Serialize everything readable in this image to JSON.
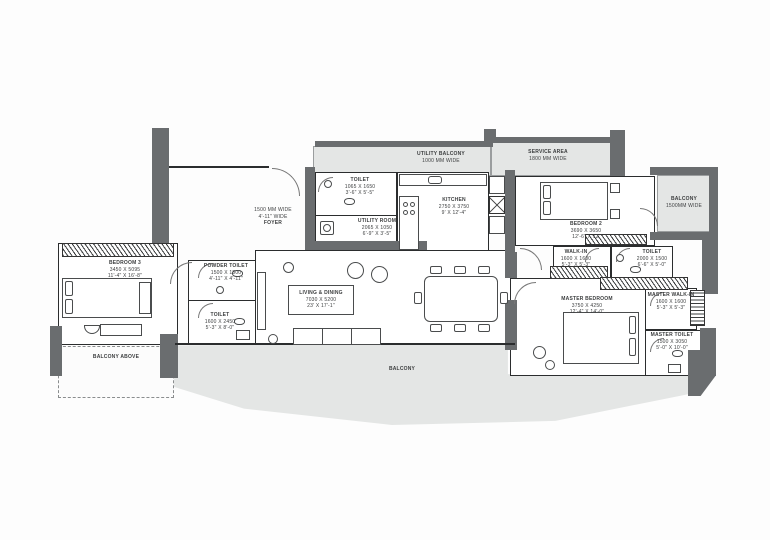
{
  "plan": {
    "type": "residential-floor-plan"
  },
  "colors": {
    "wall": "#6a6d6f",
    "balcony_fill": "#e4e6e5",
    "line": "#2b2d2e",
    "text": "#3c3e3f"
  },
  "icons": [
    "bed",
    "pillow",
    "wardrobe-hatch",
    "sofa",
    "armchair",
    "coffee-table",
    "dining-table",
    "chair",
    "tv-unit",
    "kitchen-counter",
    "stove-burner",
    "sink",
    "refrigerator",
    "duct-shaft",
    "washing-machine",
    "wc",
    "door-swing",
    "dresser",
    "stool",
    "pouf",
    "bench",
    "nightstand"
  ],
  "rooms": {
    "bedroom3": {
      "name": "BEDROOM 3",
      "mm": "3450 X 5095",
      "ft": "11'-4\" X 16'-8\""
    },
    "balcony_above": {
      "name": "BALCONY ABOVE"
    },
    "powder_toilet": {
      "name": "POWDER TOILET",
      "mm": "1500 X 1500",
      "ft": "4'-11\" X 4'-11\""
    },
    "toilet_left": {
      "name": "TOILET",
      "mm": "1600 X 2450",
      "ft": "5'-3\" X 8'-0\""
    },
    "foyer": {
      "line1": "1500 MM WIDE",
      "line2": "4'-11\" WIDE",
      "line3": "FOYER"
    },
    "toilet_top": {
      "name": "TOILET",
      "mm": "1065 X 1650",
      "ft": "3'-6\" X 5'-5\""
    },
    "utility_room": {
      "name": "UTILITY ROOM",
      "mm": "2065 X 1050",
      "ft": "6'-9\" X 3'-5\""
    },
    "utility_balcony": {
      "name": "UTILITY BALCONY",
      "width": "1000 MM WIDE"
    },
    "service_area": {
      "name": "SERVICE AREA",
      "width": "1800 MM WIDE"
    },
    "kitchen": {
      "name": "KITCHEN",
      "mm": "2750 X 3750",
      "ft": "9' X 12'-4\""
    },
    "bedroom2": {
      "name": "BEDROOM 2",
      "mm": "3690 X 3650",
      "ft": "12'-6\" X 12'"
    },
    "balcony_right": {
      "name": "BALCONY",
      "width": "1500MM WIDE"
    },
    "walk_in": {
      "name": "WALK-IN",
      "mm": "1600 X 1600",
      "ft": "5'-3\" X 5'-3\""
    },
    "toilet_right": {
      "name": "TOILET",
      "mm": "2000 X 1500",
      "ft": "6'-6\" X 5'-0\""
    },
    "master_walk_in": {
      "name": "MASTER WALK-IN",
      "mm": "1600 X 1600",
      "ft": "5'-3\" X 5'-3\""
    },
    "master_bedroom": {
      "name": "MASTER BEDROOM",
      "mm": "3750 X 4250",
      "ft": "12'-4\" X 14'-0\""
    },
    "master_toilet": {
      "name": "MASTER TOILET",
      "mm": "1500 X 3050",
      "ft": "5'-0\" X 10'-0\""
    },
    "living_dining": {
      "name": "LIVING & DINING",
      "mm": "7030 X 5200",
      "ft": "23' X 17'-1\""
    },
    "balcony_main": {
      "name": "BALCONY"
    }
  }
}
